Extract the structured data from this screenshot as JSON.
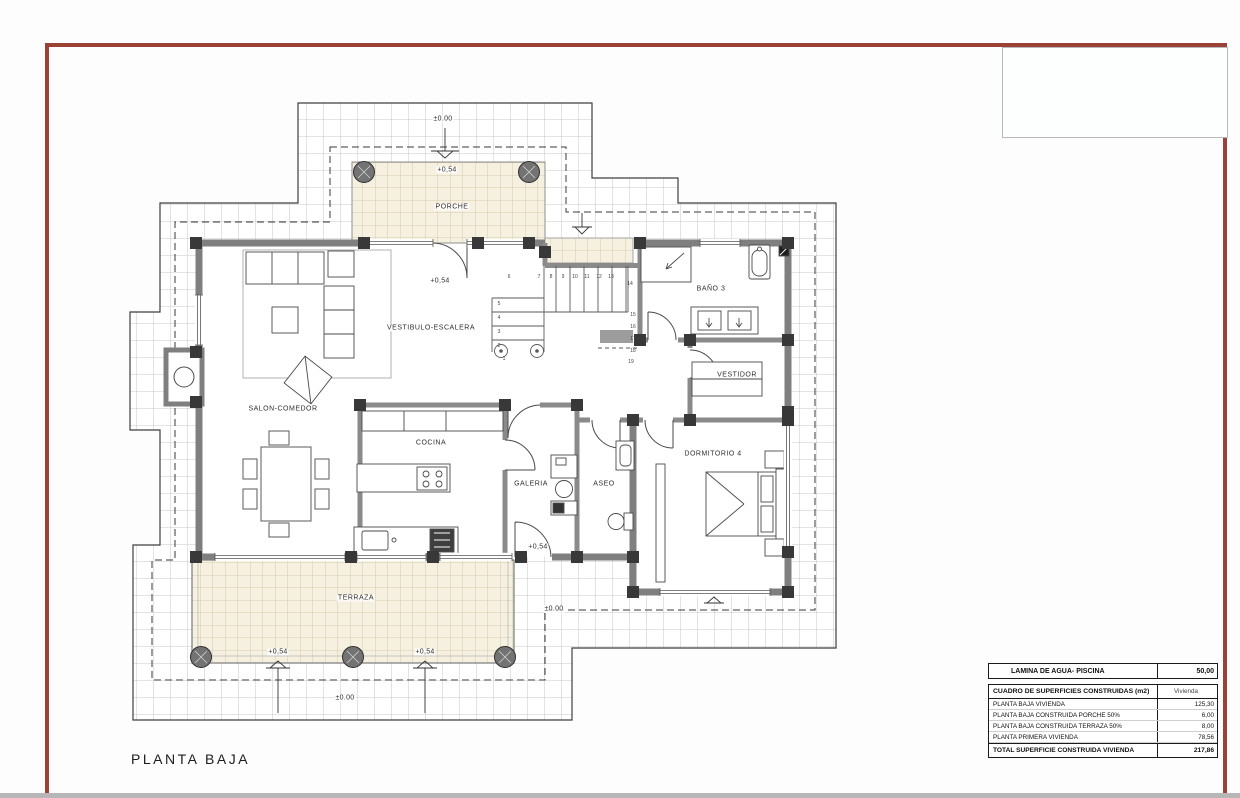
{
  "drawing": {
    "title": "PLANTA BAJA"
  },
  "room_labels": {
    "porche": "PORCHE",
    "vestibulo": "VESTIBULO-ESCALERA",
    "salon": "SALON-COMEDOR",
    "cocina": "COCINA",
    "galeria": "GALERIA",
    "aseo": "ASEO",
    "bano3": "BAÑO 3",
    "vestidor": "VESTIDOR",
    "dormitorio4": "DORMITORIO 4",
    "terraza": "TERRAZA"
  },
  "levels": {
    "zero": "±0.00",
    "plus054": "+0,54"
  },
  "stairs": {
    "step_numbers": [
      "1",
      "2",
      "3",
      "4",
      "5",
      "6",
      "7",
      "8",
      "9",
      "10",
      "11",
      "12",
      "13",
      "14",
      "15",
      "16",
      "17",
      "18",
      "19"
    ]
  },
  "areas_table": {
    "water_label": "LAMINA DE AGUA- PISCINA",
    "water_value": "50,00",
    "header_label": "CUADRO DE SUPERFICIES CONSTRUIDAS (m2)",
    "header_value": "Vivienda",
    "rows": [
      {
        "label": "PLANTA BAJA VIVIENDA",
        "value": "125,30"
      },
      {
        "label": "PLANTA BAJA CONSTRUIDA PORCHE 50%",
        "value": "6,00"
      },
      {
        "label": "PLANTA BAJA CONSTRUIDA TERRAZA 50%",
        "value": "8,00"
      },
      {
        "label": "PLANTA PRIMERA VIVIENDA",
        "value": "78,56"
      }
    ],
    "total_label": "TOTAL SUPERFICIE CONSTRUIDA VIVIENDA",
    "total_value": "217,86"
  },
  "colors": {
    "frame": "#9c4136",
    "wall": "#7f7f7f",
    "pilaster": "#383838",
    "beige_tile": "#f6f0e1"
  }
}
